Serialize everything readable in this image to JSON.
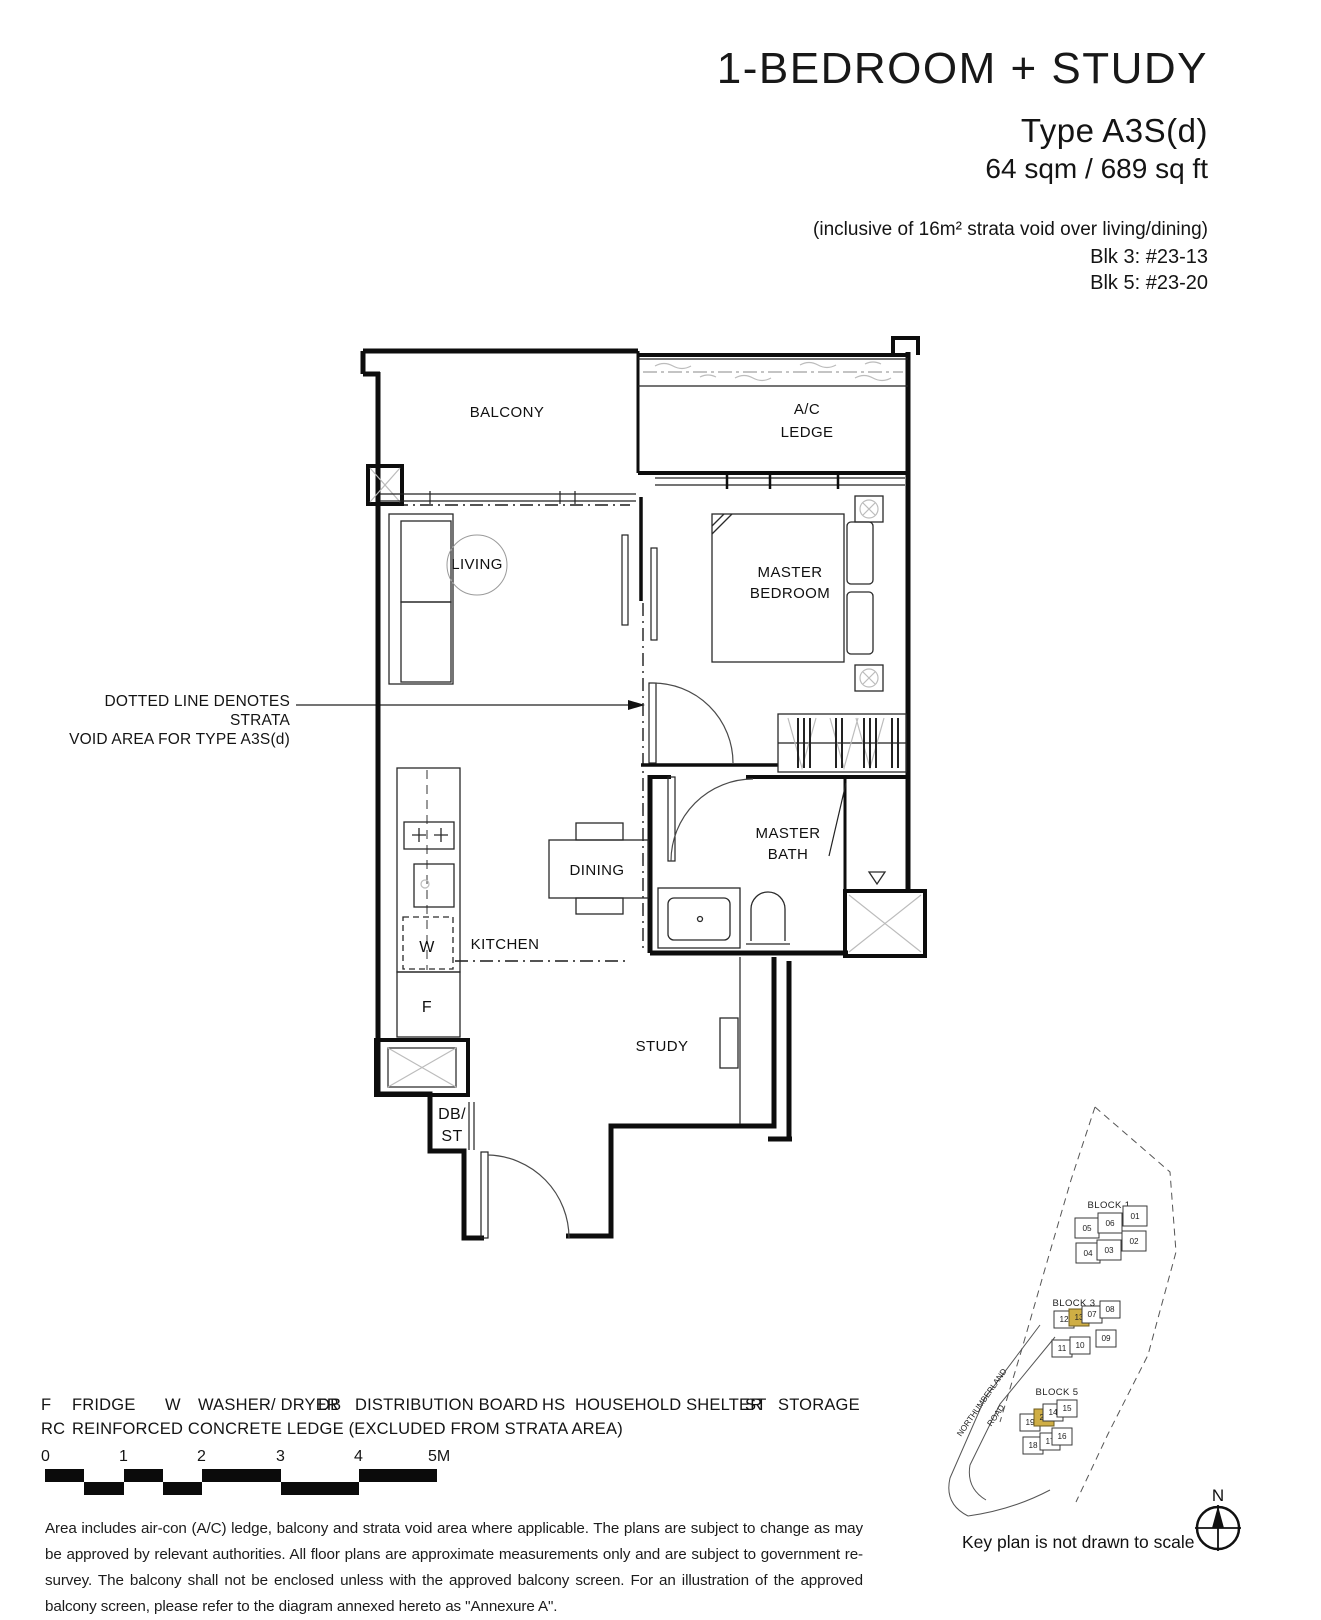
{
  "header": {
    "title": "1-BEDROOM + STUDY",
    "unit_type": "Type A3S(d)",
    "area": "64 sqm / 689 sq ft",
    "note": "(inclusive of 16m² strata void over living/dining)",
    "blk3": "Blk 3: #23-13",
    "blk5": "Blk 5: #23-20"
  },
  "annotation": {
    "line1": "DOTTED LINE DENOTES STRATA",
    "line2": "VOID AREA FOR TYPE A3S(d)"
  },
  "plan": {
    "balcony": "BALCONY",
    "ac1": "A/C",
    "ac2": "LEDGE",
    "living": "LIVING",
    "master1": "MASTER",
    "master2": "BEDROOM",
    "dining": "DINING",
    "bath1": "MASTER",
    "bath2": "BATH",
    "kitchen": "KITCHEN",
    "study": "STUDY",
    "db1": "DB/",
    "db2": "ST",
    "washer": "W",
    "fridge": "F"
  },
  "legend": {
    "items": [
      {
        "abbr": "F",
        "label": "FRIDGE"
      },
      {
        "abbr": "W",
        "label": "WASHER/ DRYER"
      },
      {
        "abbr": "DB",
        "label": "DISTRIBUTION BOARD"
      },
      {
        "abbr": "HS",
        "label": "HOUSEHOLD SHELTER"
      },
      {
        "abbr": "ST",
        "label": "STORAGE"
      }
    ],
    "rc_abbr": "RC",
    "rc_label": "REINFORCED CONCRETE LEDGE (EXCLUDED FROM STRATA AREA)"
  },
  "scale_bar": {
    "labels": [
      "0",
      "1",
      "2",
      "3",
      "4",
      "5M"
    ]
  },
  "disclaimer": "Area includes air-con (A/C) ledge, balcony and strata void area where applicable. The plans are subject to change as may be approved by relevant authorities. All floor plans are approximate measurements only and are subject to government re-survey. The balcony shall not be enclosed unless with the approved balcony screen. For an illustration of the approved balcony screen, please refer to the diagram annexed hereto as \"Annexure A\".",
  "key_plan": {
    "blocks": [
      {
        "name": "BLOCK 1",
        "units": [
          "05",
          "06",
          "01",
          "04",
          "03",
          "02"
        ]
      },
      {
        "name": "BLOCK 3",
        "units": [
          "12",
          "13",
          "07",
          "08",
          "11",
          "10",
          "09"
        ],
        "highlighted_unit": "13"
      },
      {
        "name": "BLOCK 5",
        "units": [
          "19",
          "20",
          "14",
          "15",
          "18",
          "17",
          "16"
        ],
        "highlighted_unit": "20"
      }
    ],
    "road1": "NORTHUMBERLAND",
    "road2": "ROAD",
    "north": "N",
    "caption": "Key plan is not drawn to scale",
    "highlight_color": "#cfae45"
  }
}
